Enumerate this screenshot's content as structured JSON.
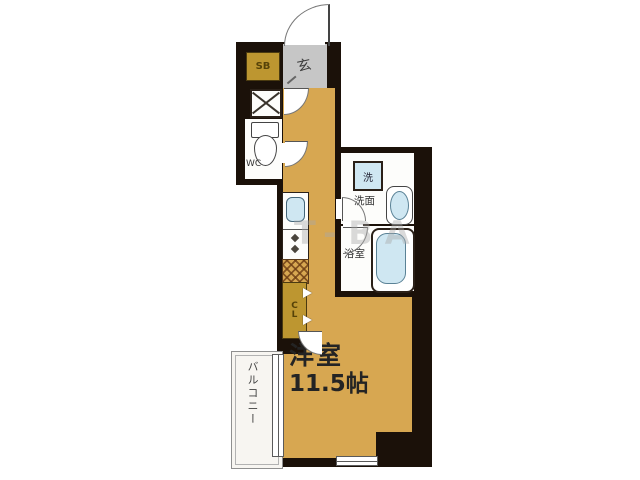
{
  "floorplan": {
    "watermark_text": "T-BA",
    "entrance_label": "玄",
    "shoe_box_label": "SB",
    "wc_label": "WC",
    "washer_label": "洗",
    "powder_room_label": "洗面",
    "bathroom_label": "浴室",
    "closet_label": "CL",
    "main_room_label": "洋室",
    "main_room_size": "11.5帖",
    "balcony_label": "バルコニー",
    "colors": {
      "floor_tan": "#d7a751",
      "storage_mustard": "#bd9630",
      "entrance_gray": "#c6c6c6",
      "fixture_blue": "#cfe7f2",
      "wall_dark": "#1b1109",
      "balcony_white": "#f7f5f1"
    }
  }
}
